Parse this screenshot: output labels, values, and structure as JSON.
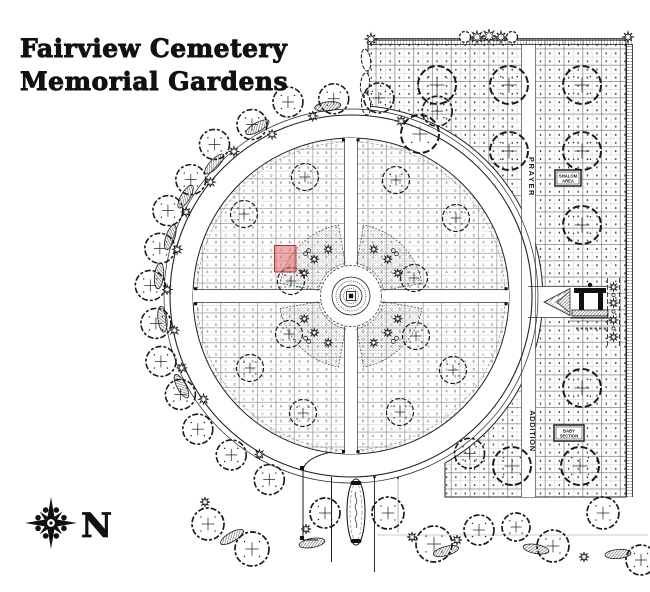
{
  "title": {
    "line1": "Fairview Cemetery",
    "line2": "Memorial Gardens"
  },
  "compass": {
    "north_label": "N"
  },
  "sections": {
    "upper_road_label": "PRAYER",
    "lower_road_label": "ADDITION"
  },
  "signs": {
    "upper": {
      "line1": "SHALOM",
      "line2": "AREA"
    },
    "lower": {
      "line1": "BABY",
      "line2": "SECTION"
    }
  },
  "highlight": {
    "plot_color": "#e06666",
    "plot_border_color": "#b03030"
  },
  "plot_cell_letters": [
    "A",
    "B",
    "C",
    "D"
  ],
  "colors": {
    "ink": "#1a1a1a",
    "paper": "#ffffff"
  }
}
